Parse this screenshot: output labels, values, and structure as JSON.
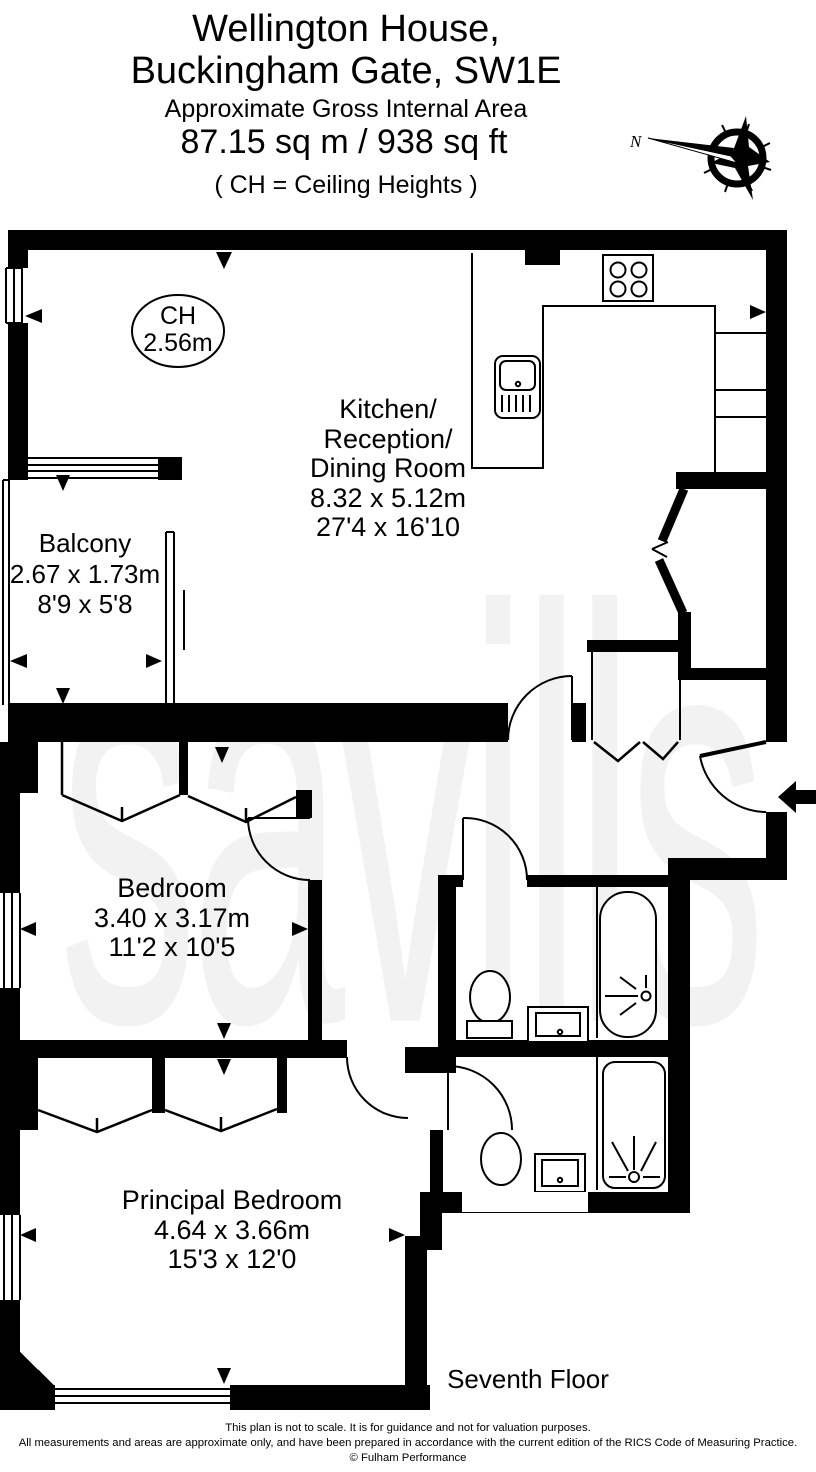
{
  "header": {
    "title_line1": "Wellington House,",
    "title_line2": "Buckingham Gate, SW1E",
    "subtitle": "Approximate Gross Internal Area",
    "area": "87.15 sq m  /  938 sq ft",
    "ceiling_note": "( CH = Ceiling Heights )"
  },
  "compass": {
    "north_label": "N"
  },
  "watermark_text": "savills",
  "plan": {
    "ceiling_height": {
      "label": "CH",
      "value": "2.56m"
    },
    "kitchen": {
      "name_line1": "Kitchen/",
      "name_line2": "Reception/",
      "name_line3": "Dining Room",
      "size_metric": "8.32 x 5.12m",
      "size_imperial": "27'4 x 16'10"
    },
    "balcony": {
      "name": "Balcony",
      "size_metric": "2.67 x 1.73m",
      "size_imperial": "8'9 x 5'8"
    },
    "bedroom": {
      "name": "Bedroom",
      "size_metric": "3.40 x 3.17m",
      "size_imperial": "11'2 x 10'5"
    },
    "principal_bedroom": {
      "name": "Principal Bedroom",
      "size_metric": "4.64 x 3.66m",
      "size_imperial": "15'3 x 12'0"
    },
    "floor_label": "Seventh Floor"
  },
  "footer": {
    "line1": "This plan is not to scale. It is for guidance and not for valuation purposes.",
    "line2": "All measurements and areas are approximate only, and have been prepared in accordance with the current edition of the RICS Code of Measuring Practice.",
    "line3": "© Fulham Performance"
  },
  "colors": {
    "wall": "#000000",
    "watermark": "#f2f2f2",
    "background": "#ffffff"
  }
}
